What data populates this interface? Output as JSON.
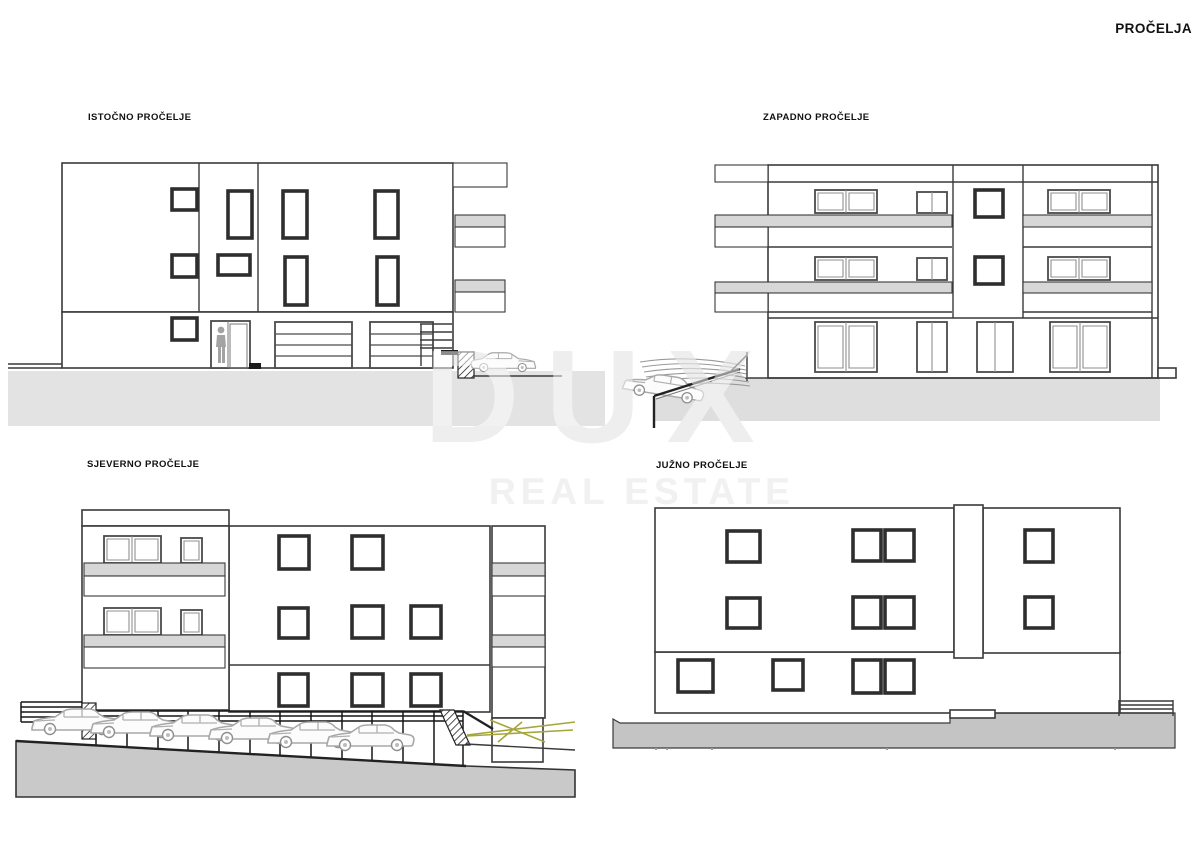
{
  "title": "PROČELJA",
  "watermark": {
    "brand": "DUX",
    "tagline": "REAL ESTATE"
  },
  "facades": [
    {
      "id": "east",
      "label": "ISTOČNO PROČELJE",
      "position": "top-left",
      "floors": 3
    },
    {
      "id": "west",
      "label": "ZAPADNO PROČELJE",
      "position": "top-right",
      "floors": 3
    },
    {
      "id": "north",
      "label": "SJEVERNO PROČELJE",
      "position": "bottom-left",
      "floors": 3
    },
    {
      "id": "south",
      "label": "JUŽNO PROČELJE",
      "position": "bottom-right",
      "floors": 3
    }
  ],
  "colors": {
    "line": "#3a3a3a",
    "window_frame": "#2e2e2e",
    "slab_gray": "#d7d7d7",
    "ground_light": "#e3e3e3",
    "ground_medium": "#dedede",
    "ground_dark": "#c9c9c9",
    "watermark_gray": "#dedede",
    "road_marking_yellow": "#a6a63c",
    "car_outline_gray": "#a8a8a8"
  }
}
